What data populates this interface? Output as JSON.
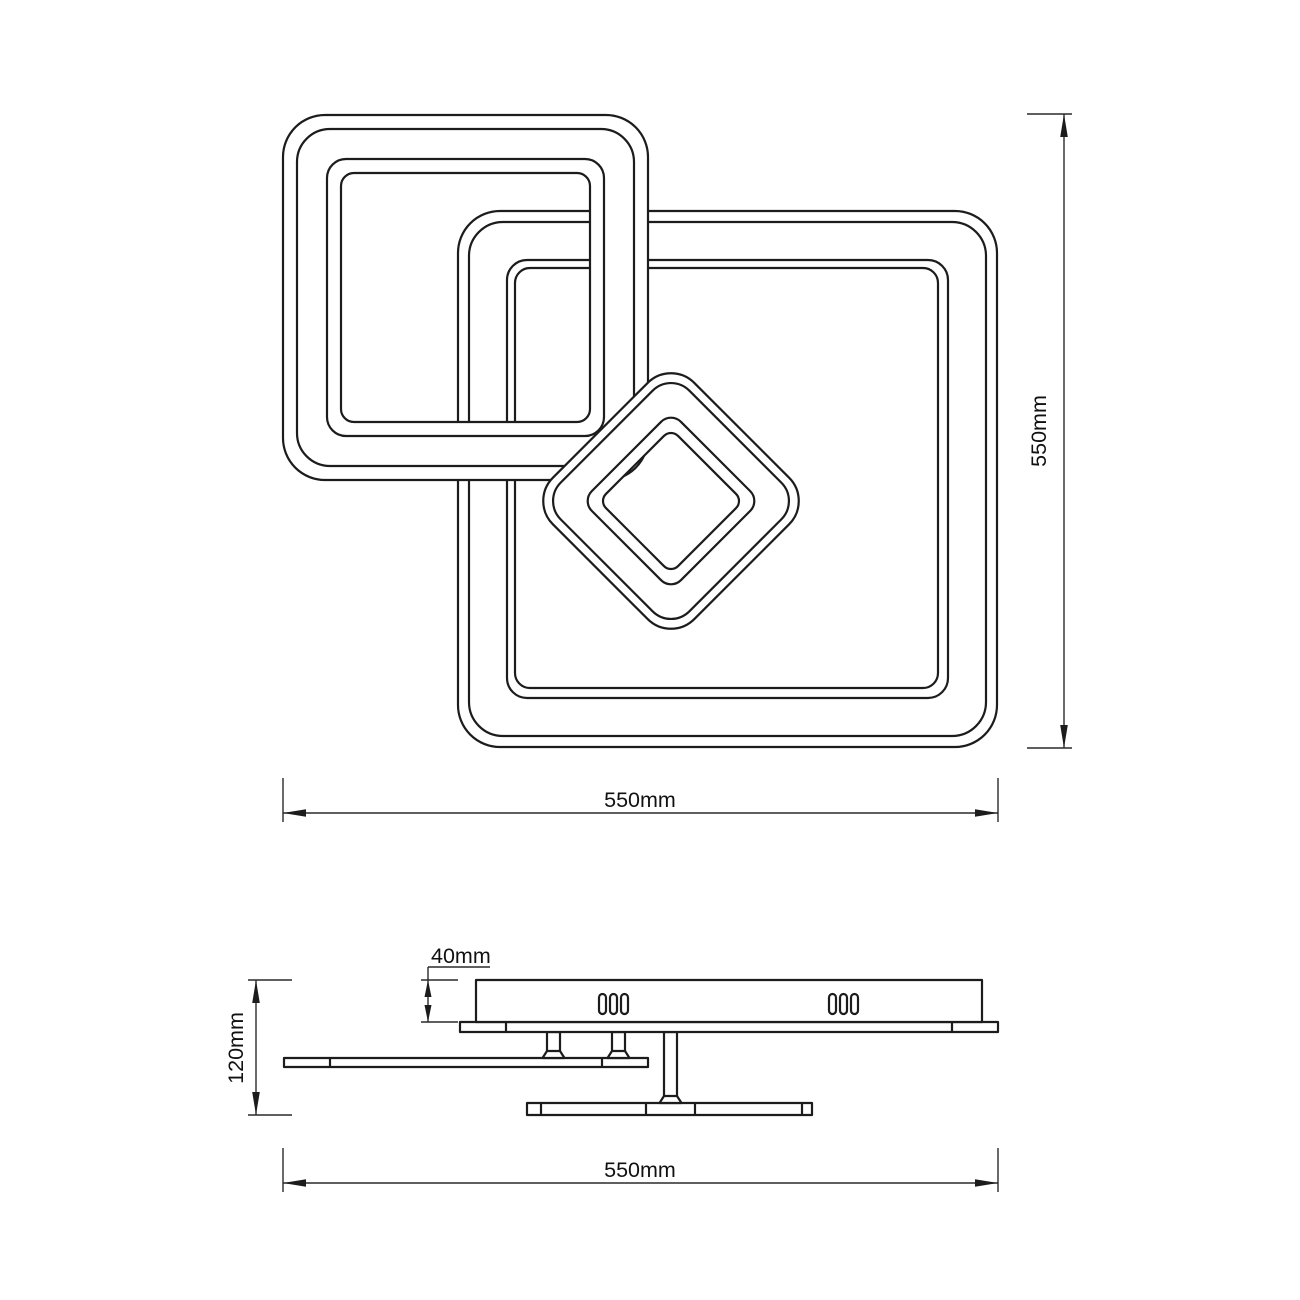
{
  "drawing": {
    "background": "#ffffff",
    "line_color": "#1c1c1c",
    "units": "mm"
  },
  "dims": {
    "top_height": "550mm",
    "top_width": "550mm",
    "body_thickness": "40mm",
    "total_height": "120mm",
    "side_width": "550mm"
  }
}
